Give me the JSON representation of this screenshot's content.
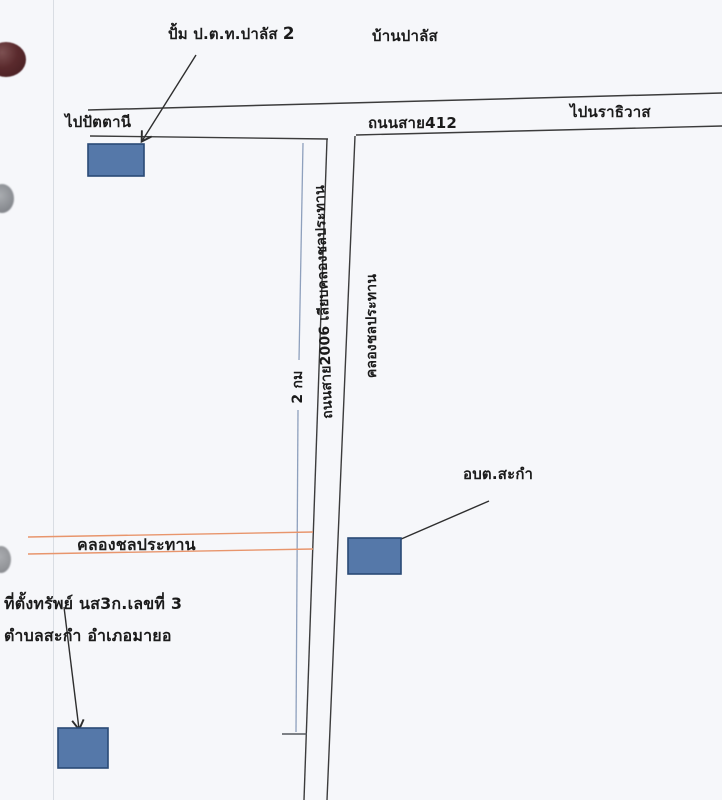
{
  "labels": {
    "gas_station": "ปั้ม ป.ต.ท.ปาลัส",
    "gas_station_number": "2",
    "village": "บ้านปาลัส",
    "to_pattani": "ไปปัตตานี",
    "road_412": "ถนนสาย412",
    "to_narathiwat": "ไปนราธิวาส",
    "road_2006": "ถนนสาย2006 เลียบคลองชลประทาน",
    "canal_vertical": "คลองชลประทาน",
    "distance_marker": "2 กม",
    "subdistrict_office": "อบต.สะกำ",
    "canal_horizontal": "คลองชลประทาน",
    "property_location_line1": "ที่ตั้งทรัพย์ นส3ก.เลขที่ 3",
    "property_location_line2": "ตำบลสะกำ อำเภอมายอ"
  },
  "colors": {
    "building_fill": "#5578a9",
    "building_border": "#2a4a76",
    "canal_line": "#e8956c",
    "road_line": "#3c3c3c",
    "distance_line": "#8ea0bd",
    "page_background": "#f6f7fa"
  }
}
